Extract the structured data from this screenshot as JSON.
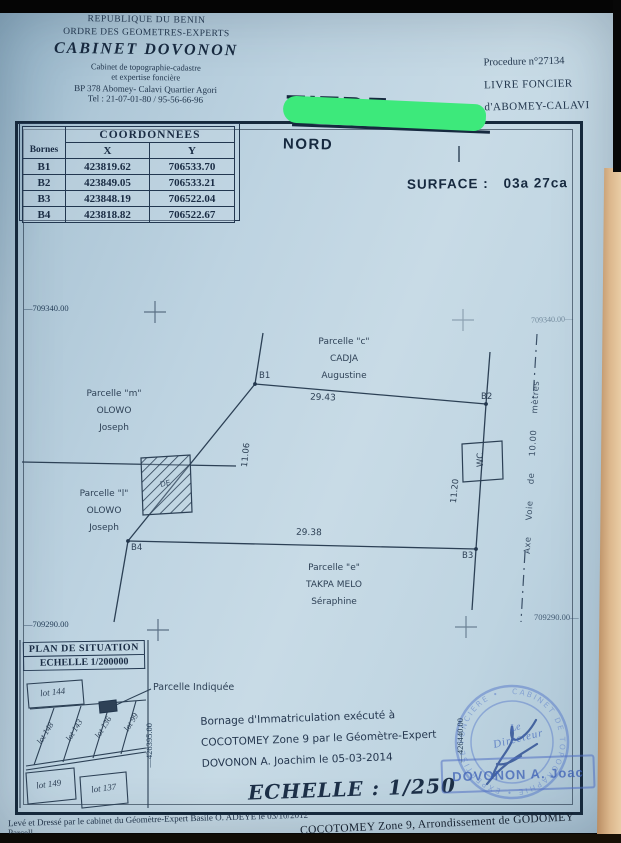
{
  "letterhead": {
    "line1": "REPUBLIQUE DU BENIN",
    "line2": "ORDRE DES GEOMETRES-EXPERTS",
    "cabinet": "CABINET  DOVONON",
    "line4": "Cabinet de topographie-cadastre",
    "line5": "et expertise foncière",
    "line6": "BP 378 Abomey- Calavi Quartier Agori",
    "line7": "Tel : 21-07-01-80 / 95-56-66-96"
  },
  "registry": {
    "procedure": "Procedure n°27134",
    "livre": "LIVRE  FONCIER",
    "of": "d'ABOMEY-CALAVI"
  },
  "title": {
    "label": "TITRE",
    "redaction_color": "#3de97b"
  },
  "north_label": "NORD",
  "surface": {
    "label": "SURFACE :",
    "value": "03a 27ca"
  },
  "coordinates_table": {
    "title": "COORDONNEES",
    "col_borne": "Bornes",
    "col_x": "X",
    "col_y": "Y",
    "rows": [
      {
        "b": "B1",
        "x": "423819.62",
        "y": "706533.70"
      },
      {
        "b": "B2",
        "x": "423849.05",
        "y": "706533.21"
      },
      {
        "b": "B3",
        "x": "423848.19",
        "y": "706522.04"
      },
      {
        "b": "B4",
        "x": "423818.82",
        "y": "706522.67"
      }
    ]
  },
  "grid": {
    "nw": "—709340.00",
    "ne": "709340.00—",
    "sw": "—709290.00",
    "se": "709290.00—",
    "v_left": "—426395.00",
    "v_right": "—426440.00"
  },
  "plan": {
    "b1": "B1",
    "b2": "B2",
    "b3": "B3",
    "b4": "B4",
    "dim_top": "29.43",
    "dim_bottom": "29.38",
    "dim_left": "11.06",
    "dim_right": "11.20",
    "wc": "WC",
    "building": "DE",
    "road_axis": "Axe Voie de 10.00 mètres",
    "parcel_north_1": "Parcelle \"c\"",
    "parcel_north_2": "CADJA",
    "parcel_north_3": "Augustine",
    "parcel_west_up_1": "Parcelle \"m\"",
    "parcel_west_up_2": "OLOWO",
    "parcel_west_up_3": "Joseph",
    "parcel_west_lo_1": "Parcelle \"l\"",
    "parcel_west_lo_2": "OLOWO",
    "parcel_west_lo_3": "Joseph",
    "parcel_south_1": "Parcelle \"e\"",
    "parcel_south_2": "TAKPA MELO",
    "parcel_south_3": "Séraphine"
  },
  "situation": {
    "title": "PLAN  DE  SITUATION",
    "scale": "ECHELLE   1/200000",
    "lots": [
      "lot 144",
      "lot 148",
      "lot 143",
      "lot 136",
      "lot 99",
      "lot 149",
      "lot 137"
    ],
    "indicated": "Parcelle  Indiquée"
  },
  "certificate": {
    "line1": "Bornage d'Immatriculation exécuté à",
    "line2": "COCOTOMEY Zone 9 par le Géomètre-Expert",
    "line3": "DOVONON A. Joachim le 05-03-2014",
    "scale": "ECHELLE : 1/250"
  },
  "stamp": {
    "ring": "CABINET DE TOPOGRAPHIE • EXPERTISE FONCIERE •",
    "center1": "Le",
    "center2": "Directeur",
    "name": "DOVONON A. Joac"
  },
  "footer": {
    "line1": "Levé et Dressé par le cabinet du Géomètre-Expert Basile O. ADEYE  le 03/10/2012",
    "line2": "COCOTOMEY Zone 9, Arrondissement de GODOMEY",
    "partial": "Parcell"
  }
}
